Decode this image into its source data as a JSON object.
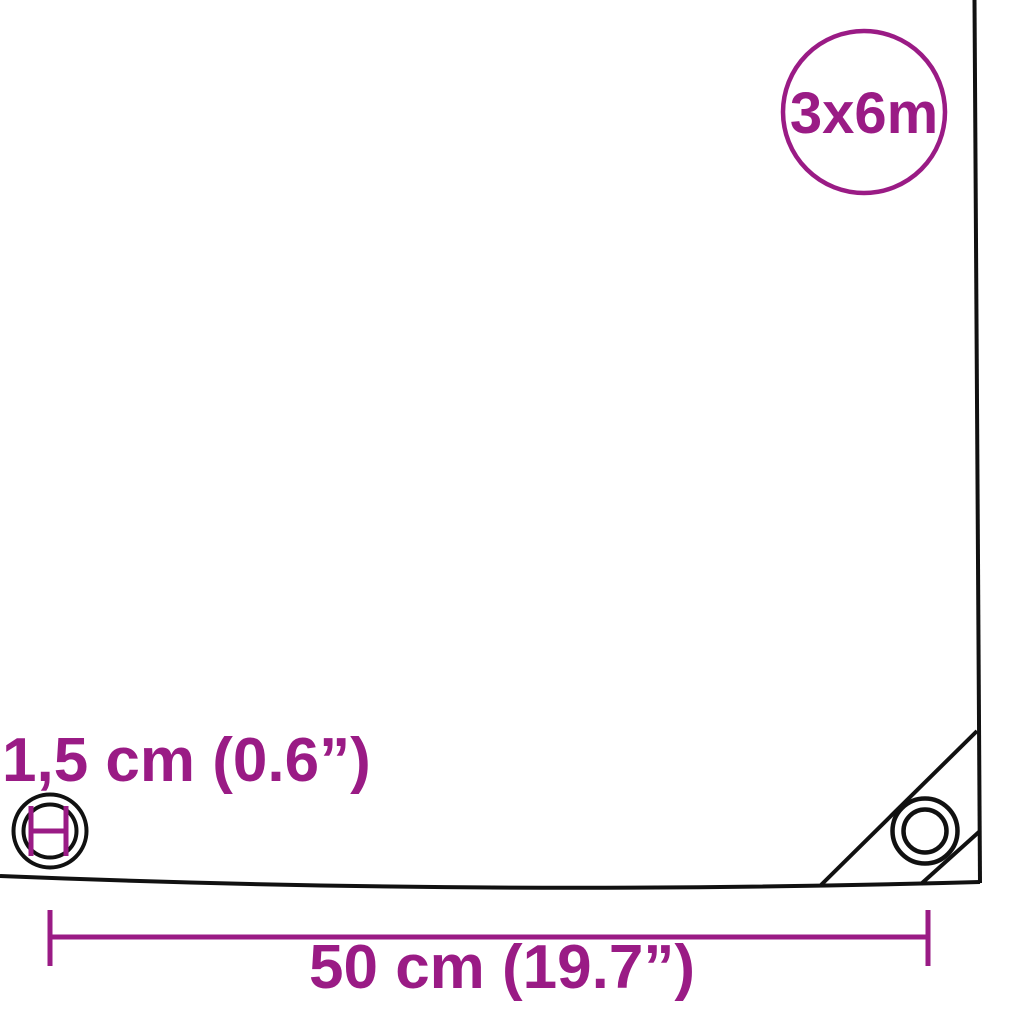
{
  "badge": {
    "label": "3x6m"
  },
  "dimensions": {
    "eyelet_diameter": {
      "label": "1,5 cm (0.6”)"
    },
    "eyelet_spacing": {
      "label": "50 cm (19.7”)"
    }
  },
  "icons": {
    "size_badge": "size-badge-circle",
    "eyelet_diameter": "eyelet-diameter-icon",
    "corner_eyelet": "corner-eyelet-icon"
  },
  "colors": {
    "accent": "#9a1b85",
    "line": "#111111",
    "background": "#ffffff"
  }
}
